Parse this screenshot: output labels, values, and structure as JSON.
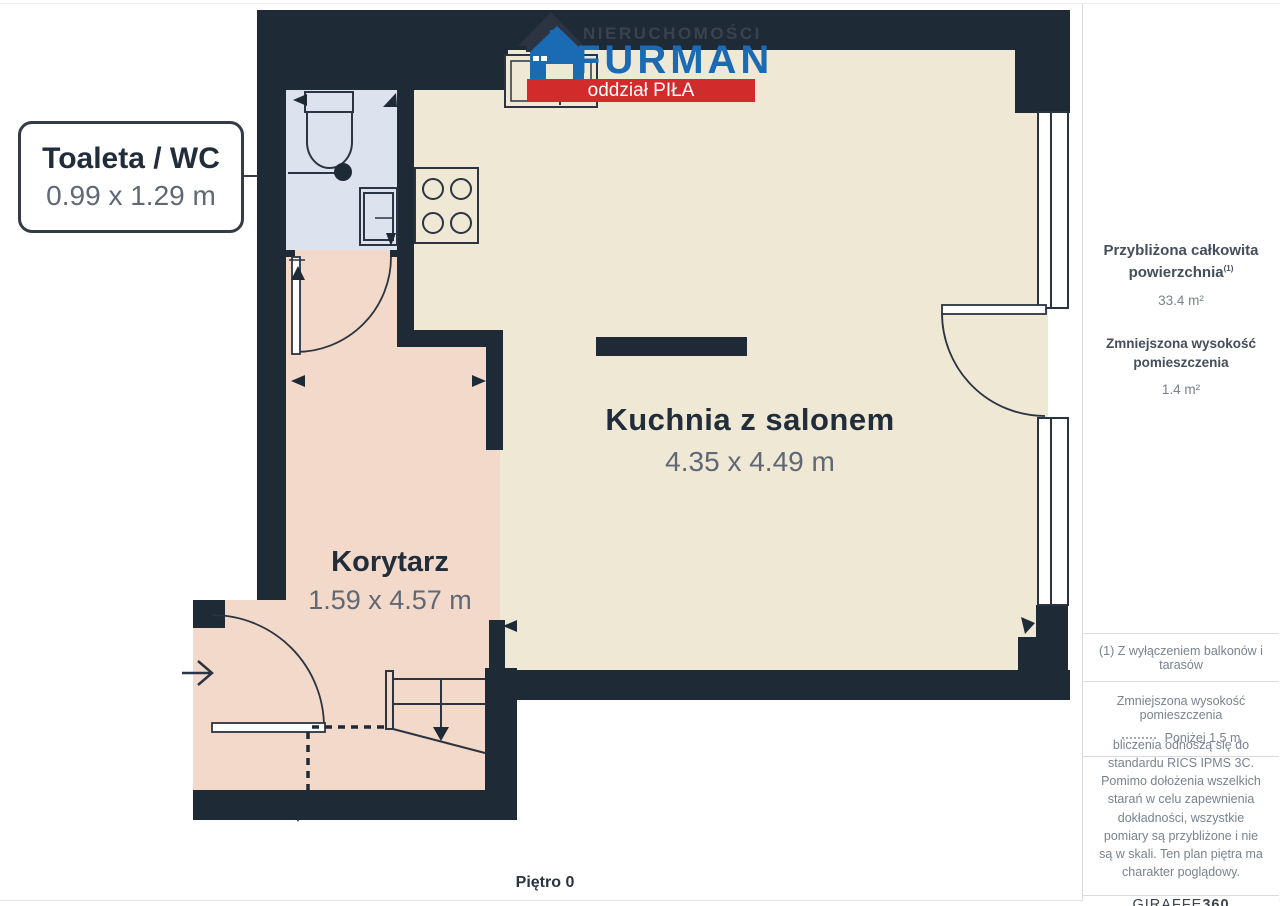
{
  "logo": {
    "line1": "NIERUCHOMOŚCI",
    "line2": "FURMAN",
    "banner": "oddział PIŁA"
  },
  "rooms": {
    "toilet": {
      "name": "Toaleta / WC",
      "dims": "0.99 x 1.29 m"
    },
    "kitchen": {
      "name": "Kuchnia z salonem",
      "dims": "4.35 x 4.49 m"
    },
    "corridor": {
      "name": "Korytarz",
      "dims": "1.59 x 4.57 m"
    }
  },
  "floor_label": "Piętro 0",
  "sidebar": {
    "total_area_title_line1": "Przybliżona całkowita",
    "total_area_title_line2": "powierzchnia",
    "footnote_ref": "(1)",
    "total_area_value": "33.4 m²",
    "reduced_height_title": "Zmniejszona wysokość pomieszczenia",
    "reduced_height_value": "1.4 m²",
    "footnote": "(1) Z wyłączeniem balkonów i tarasów",
    "legend_title": "Zmniejszona wysokość pomieszczenia",
    "legend_value": "Poniżej 1.5 m",
    "disclaimer": "bliczenia odnoszą się do standardu RICS IPMS 3C. Pomimo dołożenia wszelkich starań w celu zapewnienia dokładności, wszystkie pomiary są przybliżone i nie są w skali. Ten plan piętra ma charakter poglądowy.",
    "brand": "GIRAFFE",
    "brand_bold": "360"
  },
  "colors": {
    "wall": "#1f2a37",
    "kitchen_floor": "#eee8d5",
    "corridor_floor": "#f3d9c9",
    "toilet_floor": "#dde3ee",
    "logo_blue": "#1b6ab4",
    "banner_red": "#d22b2b"
  }
}
